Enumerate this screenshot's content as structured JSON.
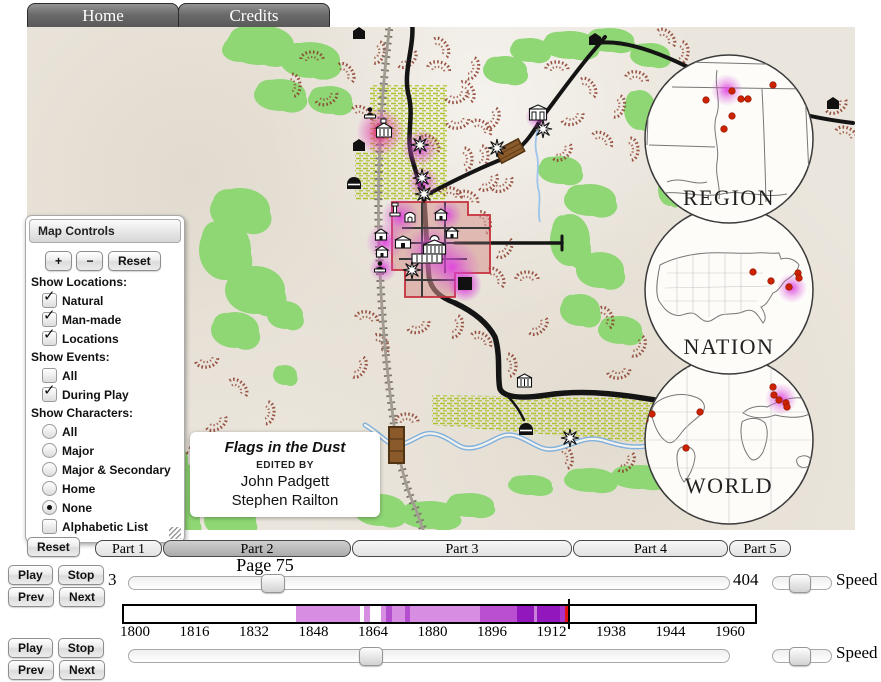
{
  "nav": {
    "tabs": [
      {
        "label": "Home"
      },
      {
        "label": "Credits"
      }
    ]
  },
  "map_controls": {
    "title": "Map Controls",
    "zoom_in": "+",
    "zoom_out": "−",
    "reset": "Reset",
    "sections": [
      {
        "heading": "Show Locations:",
        "items": [
          {
            "type": "checkbox",
            "label": "Natural",
            "checked": true
          },
          {
            "type": "checkbox",
            "label": "Man-made",
            "checked": true
          },
          {
            "type": "checkbox",
            "label": "Locations",
            "checked": true
          }
        ]
      },
      {
        "heading": "Show Events:",
        "items": [
          {
            "type": "checkbox",
            "label": "All",
            "checked": false
          },
          {
            "type": "checkbox",
            "label": "During Play",
            "checked": true
          }
        ]
      },
      {
        "heading": "Show Characters:",
        "items": [
          {
            "type": "radio",
            "label": "All",
            "checked": false
          },
          {
            "type": "radio",
            "label": "Major",
            "checked": false
          },
          {
            "type": "radio",
            "label": "Major & Secondary",
            "checked": false
          },
          {
            "type": "radio",
            "label": "Home",
            "checked": false
          },
          {
            "type": "radio",
            "label": "None",
            "checked": true
          },
          {
            "type": "checkbox",
            "label": "Alphabetic List",
            "checked": false
          }
        ]
      }
    ]
  },
  "credits_box": {
    "title": "Flags in the Dust",
    "subtitle": "EDITED BY",
    "editors": [
      "John Padgett",
      "Stephen Railton"
    ]
  },
  "insets": [
    {
      "label": "REGION",
      "cx": 702,
      "cy": 112,
      "label_y": 178,
      "dots": [
        [
          679,
          73
        ],
        [
          705,
          64
        ],
        [
          746,
          58
        ],
        [
          714,
          72
        ],
        [
          721,
          72
        ],
        [
          705,
          89
        ],
        [
          697,
          102
        ]
      ],
      "glow": [
        700,
        63,
        16
      ]
    },
    {
      "label": "NATION",
      "cx": 702,
      "cy": 263,
      "label_y": 327,
      "dots": [
        [
          726,
          245
        ],
        [
          744,
          254
        ],
        [
          762,
          260
        ],
        [
          771,
          246
        ],
        [
          772,
          251
        ]
      ],
      "glow": [
        765,
        261,
        15
      ]
    },
    {
      "label": "WORLD",
      "cx": 702,
      "cy": 413,
      "label_y": 466,
      "dots": [
        [
          618,
          393
        ],
        [
          625,
          387
        ],
        [
          673,
          385
        ],
        [
          659,
          421
        ],
        [
          746,
          360
        ],
        [
          747,
          368
        ],
        [
          752,
          373
        ],
        [
          759,
          376
        ],
        [
          760,
          380
        ]
      ],
      "glow": [
        754,
        372,
        16
      ]
    }
  ],
  "playback": {
    "reset": "Reset",
    "parts": [
      {
        "label": "Part 1",
        "active": false
      },
      {
        "label": "Part 2",
        "active": true
      },
      {
        "label": "Part 3",
        "active": false
      },
      {
        "label": "Part 4",
        "active": false
      },
      {
        "label": "Part 5",
        "active": false
      }
    ],
    "page_label": "Page 75",
    "page_min": "3",
    "page_max": "404",
    "page_value": 75,
    "page_thumb_percent": 23,
    "rows": [
      {
        "play": "Play",
        "stop": "Stop",
        "prev": "Prev",
        "next": "Next",
        "speed_label": "Speed",
        "speed_percent": 45
      },
      {
        "play": "Play",
        "stop": "Stop",
        "prev": "Prev",
        "next": "Next",
        "speed_label": "Speed",
        "speed_percent": 45
      }
    ],
    "bottom_thumb_percent": 40
  },
  "timeline": {
    "start": 1800,
    "end": 1960,
    "tick_labels": [
      "1800",
      "1816",
      "1832",
      "1848",
      "1864",
      "1880",
      "1896",
      "1912",
      "1938",
      "1944",
      "1960"
    ],
    "segments": [
      {
        "from": 1843,
        "to": 1860.5,
        "color": "#d78de2"
      },
      {
        "from": 1861.5,
        "to": 1863,
        "color": "#d78de2"
      },
      {
        "from": 1866,
        "to": 1893,
        "color": "#d78de2"
      },
      {
        "from": 1867.5,
        "to": 1869,
        "color": "#b44fd0"
      },
      {
        "from": 1872.5,
        "to": 1874,
        "color": "#b44fd0"
      },
      {
        "from": 1893,
        "to": 1903,
        "color": "#bb4fd2"
      },
      {
        "from": 1903,
        "to": 1914.5,
        "color": "#9218bd"
      },
      {
        "from": 1907.6,
        "to": 1908.3,
        "color": "#c77fd8"
      },
      {
        "from": 1914.5,
        "to": 1916,
        "color": "#a835c8"
      }
    ],
    "marker_year": 1916,
    "marker_color": "#e51212"
  },
  "map_features": {
    "greens": [
      [
        233,
        18,
        34,
        20
      ],
      [
        283,
        33,
        30,
        18
      ],
      [
        253,
        68,
        26,
        16
      ],
      [
        303,
        73,
        22,
        14
      ],
      [
        213,
        23,
        18,
        12
      ],
      [
        543,
        18,
        28,
        14
      ],
      [
        583,
        13,
        24,
        12
      ],
      [
        623,
        28,
        20,
        12
      ],
      [
        613,
        83,
        16,
        20
      ],
      [
        503,
        23,
        20,
        12
      ],
      [
        478,
        43,
        22,
        14
      ],
      [
        213,
        183,
        30,
        22
      ],
      [
        198,
        223,
        26,
        30
      ],
      [
        228,
        263,
        30,
        24
      ],
      [
        208,
        303,
        24,
        18
      ],
      [
        258,
        288,
        18,
        14
      ],
      [
        258,
        348,
        12,
        10
      ],
      [
        133,
        433,
        28,
        22
      ],
      [
        173,
        463,
        34,
        26
      ],
      [
        143,
        493,
        30,
        20
      ],
      [
        203,
        493,
        26,
        18
      ],
      [
        113,
        473,
        18,
        14
      ],
      [
        353,
        483,
        26,
        16
      ],
      [
        403,
        488,
        30,
        14
      ],
      [
        443,
        478,
        24,
        12
      ],
      [
        503,
        458,
        22,
        10
      ],
      [
        563,
        453,
        26,
        12
      ],
      [
        613,
        450,
        30,
        12
      ],
      [
        533,
        143,
        22,
        14
      ],
      [
        563,
        173,
        26,
        16
      ],
      [
        543,
        213,
        20,
        26
      ],
      [
        573,
        243,
        24,
        18
      ],
      [
        553,
        283,
        20,
        16
      ],
      [
        593,
        303,
        22,
        14
      ],
      [
        633,
        113,
        14,
        18
      ],
      [
        643,
        163,
        12,
        16
      ]
    ],
    "hills": [
      [
        285,
        30
      ],
      [
        320,
        45
      ],
      [
        352,
        26
      ],
      [
        300,
        72
      ],
      [
        336,
        86
      ],
      [
        268,
        58
      ],
      [
        381,
        33
      ],
      [
        412,
        40
      ],
      [
        441,
        64
      ],
      [
        466,
        92
      ],
      [
        431,
        96
      ],
      [
        404,
        116
      ],
      [
        456,
        130
      ],
      [
        476,
        158
      ],
      [
        441,
        170
      ],
      [
        458,
        195
      ],
      [
        478,
        222
      ],
      [
        500,
        250
      ],
      [
        470,
        250
      ],
      [
        430,
        300
      ],
      [
        392,
        300
      ],
      [
        455,
        312
      ],
      [
        484,
        338
      ],
      [
        512,
        300
      ],
      [
        340,
        290
      ],
      [
        355,
        317
      ],
      [
        333,
        341
      ],
      [
        180,
        335
      ],
      [
        212,
        360
      ],
      [
        242,
        386
      ],
      [
        190,
        397
      ],
      [
        226,
        416
      ],
      [
        256,
        421
      ],
      [
        168,
        418
      ],
      [
        530,
        40
      ],
      [
        562,
        60
      ],
      [
        592,
        80
      ],
      [
        546,
        92
      ],
      [
        576,
        112
      ],
      [
        606,
        122
      ],
      [
        536,
        126
      ],
      [
        610,
        50
      ],
      [
        580,
        290
      ],
      [
        612,
        320
      ],
      [
        592,
        346
      ],
      [
        640,
        10
      ],
      [
        656,
        26
      ],
      [
        810,
        80
      ],
      [
        820,
        106
      ],
      [
        540,
        430
      ],
      [
        600,
        436
      ],
      [
        380,
        392
      ],
      [
        415,
        20
      ],
      [
        446,
        42
      ],
      [
        430,
        70
      ],
      [
        455,
        100
      ],
      [
        440,
        132
      ],
      [
        462,
        156
      ],
      [
        424,
        166
      ]
    ],
    "buildings": [
      {
        "type": "mansion",
        "x": 349,
        "y": 96
      },
      {
        "type": "person",
        "x": 339,
        "y": 80
      },
      {
        "type": "bhouse",
        "x": 326,
        "y": 112
      },
      {
        "type": "bhut",
        "x": 320,
        "y": 148
      },
      {
        "type": "bhouse",
        "x": 326,
        "y": 0
      },
      {
        "type": "bhouse",
        "x": 562,
        "y": 6
      },
      {
        "type": "store2",
        "x": 502,
        "y": 78
      },
      {
        "type": "monument",
        "x": 363,
        "y": 176
      },
      {
        "type": "chapel",
        "x": 378,
        "y": 183
      },
      {
        "type": "house",
        "x": 408,
        "y": 182
      },
      {
        "type": "house",
        "x": 419,
        "y": 200
      },
      {
        "type": "house",
        "x": 348,
        "y": 202
      },
      {
        "type": "house",
        "x": 349,
        "y": 219
      },
      {
        "type": "housew",
        "x": 368,
        "y": 209
      },
      {
        "type": "courthouse",
        "x": 396,
        "y": 210
      },
      {
        "type": "rowhouse",
        "x": 385,
        "y": 227
      },
      {
        "type": "person",
        "x": 349,
        "y": 234
      },
      {
        "type": "bsquare",
        "x": 431,
        "y": 250
      },
      {
        "type": "plantation",
        "x": 490,
        "y": 347
      },
      {
        "type": "bhut",
        "x": 492,
        "y": 394
      },
      {
        "type": "bhouse",
        "x": 800,
        "y": 70
      }
    ],
    "stars": [
      [
        393,
        118
      ],
      [
        395,
        151
      ],
      [
        397,
        167
      ],
      [
        385,
        243
      ],
      [
        470,
        121
      ],
      [
        516,
        102
      ],
      [
        543,
        411
      ]
    ],
    "glows": [
      {
        "x": 353,
        "y": 105,
        "r": 24,
        "k": "red"
      },
      {
        "x": 393,
        "y": 121,
        "r": 19,
        "k": "mag"
      },
      {
        "x": 396,
        "y": 155,
        "r": 16,
        "k": "mag"
      },
      {
        "x": 373,
        "y": 190,
        "r": 19,
        "k": "mag"
      },
      {
        "x": 358,
        "y": 215,
        "r": 19,
        "k": "mag"
      },
      {
        "x": 356,
        "y": 241,
        "r": 14,
        "k": "mag"
      },
      {
        "x": 404,
        "y": 224,
        "r": 26,
        "k": "mag"
      },
      {
        "x": 425,
        "y": 240,
        "r": 28,
        "k": "mag"
      },
      {
        "x": 438,
        "y": 258,
        "r": 17,
        "k": "hot"
      },
      {
        "x": 420,
        "y": 188,
        "r": 15,
        "k": "mag"
      },
      {
        "x": 510,
        "y": 90,
        "r": 12,
        "k": "mag"
      }
    ]
  }
}
